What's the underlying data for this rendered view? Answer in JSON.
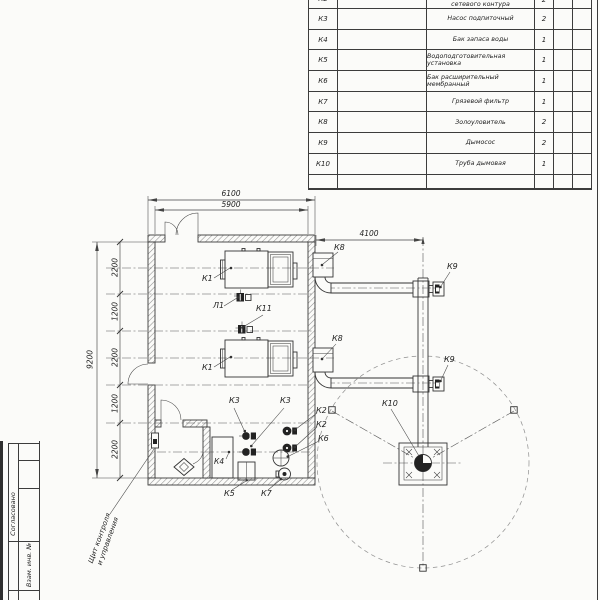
{
  "equipment_table": {
    "rows": [
      {
        "pos": "К2",
        "name": "сетевого контура",
        "qty": "2"
      },
      {
        "pos": "К3",
        "name": "Насос подпиточный",
        "qty": "2"
      },
      {
        "pos": "К4",
        "name": "Бак запаса воды",
        "qty": "1"
      },
      {
        "pos": "К5",
        "name": "Водоподготовительная установка",
        "qty": "1"
      },
      {
        "pos": "К6",
        "name": "Бак расширительный мембранный",
        "qty": "1"
      },
      {
        "pos": "К7",
        "name": "Грязевой фильтр",
        "qty": "1"
      },
      {
        "pos": "К8",
        "name": "Золоуловитель",
        "qty": "2"
      },
      {
        "pos": "К9",
        "name": "Дымосос",
        "qty": "2"
      },
      {
        "pos": "К10",
        "name": "Труба дымовая",
        "qty": "1"
      }
    ]
  },
  "dims": {
    "building_width_outer": "6100",
    "building_width_inner": "5900",
    "flue_length": "4100",
    "building_depth": "9200",
    "left_segments": [
      "2200",
      "1200",
      "2200",
      "1200",
      "2200"
    ]
  },
  "callouts": {
    "k1_top": "К1",
    "k1_bottom": "К1",
    "l1": "Л1",
    "k11": "К11",
    "k8_top": "К8",
    "k8_bottom": "К8",
    "k9_top": "К9",
    "k9_bottom": "К9",
    "k10": "К10",
    "k3_left": "К3",
    "k3_right": "К3",
    "k2_upper": "К2",
    "k2_lower": "К2",
    "k6": "К6",
    "k4": "К4",
    "k5": "К5",
    "k7": "К7"
  },
  "annotations": {
    "control_panel_line1": "Щит контроля",
    "control_panel_line2": "и управления"
  },
  "title_block": {
    "soglasovano": "Согласовано",
    "vzam_inv": "Взам. инв. №"
  },
  "colors": {
    "line": "#3a3a3a",
    "background": "#fbfbf9"
  }
}
